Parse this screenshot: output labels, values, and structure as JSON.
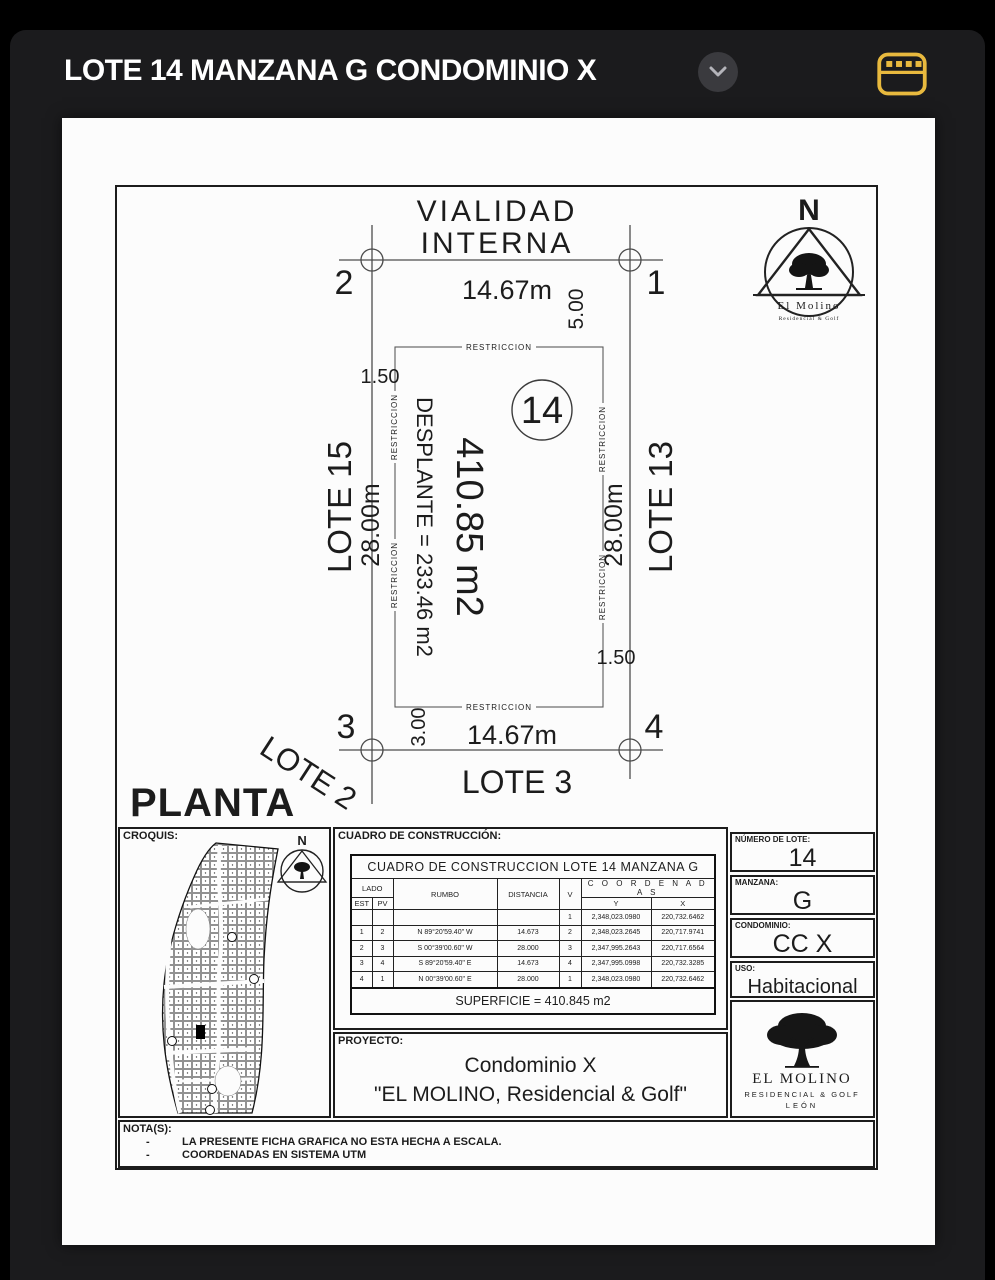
{
  "app": {
    "title": "LOTE 14 MANZANA G CONDOMINIO X",
    "accent_color": "#E8B93E"
  },
  "planta": {
    "street": {
      "line1": "VIALIDAD",
      "line2": "INTERNA"
    },
    "corner1": "1",
    "corner2": "2",
    "corner3": "3",
    "corner4": "4",
    "dim_front": "14.67m",
    "dim_rear": "14.67m",
    "dim_left": "28.00m",
    "dim_right": "28.00m",
    "setback_front": "5.00",
    "setback_rear": "3.00",
    "setback_left": "1.50",
    "setback_right": "1.50",
    "restriccion": "RESTRICCION",
    "lot_number": "14",
    "area": "410.85 m2",
    "desplante": "DESPLANTE = 233.46 m2",
    "lote_left": "LOTE 15",
    "lote_right": "LOTE 13",
    "lote_bottom_left": "LOTE 2",
    "lote_bottom": "LOTE 3",
    "view_label": "PLANTA",
    "north": {
      "letter": "N",
      "brand": "El Molino",
      "sub": "Residencial & Golf"
    }
  },
  "croquis": {
    "label": "CROQUIS:",
    "north_letter": "N"
  },
  "cuadro": {
    "label": "CUADRO DE CONSTRUCCIÓN:",
    "table_title": "CUADRO DE CONSTRUCCION LOTE 14 MANZANA G",
    "headers": {
      "lado": "LADO",
      "est": "EST",
      "pv": "PV",
      "rumbo": "RUMBO",
      "distancia": "DISTANCIA",
      "v": "V",
      "coordenadas": "C O O R D E N A D A S",
      "y": "Y",
      "x": "X"
    },
    "rows": [
      {
        "est": "",
        "pv": "",
        "rumbo": "",
        "dist": "",
        "v": "1",
        "y": "2,348,023.0980",
        "x": "220,732.6462"
      },
      {
        "est": "1",
        "pv": "2",
        "rumbo": "N 89°20'59.40\" W",
        "dist": "14.673",
        "v": "2",
        "y": "2,348,023.2645",
        "x": "220,717.9741"
      },
      {
        "est": "2",
        "pv": "3",
        "rumbo": "S 00°39'00.60\" W",
        "dist": "28.000",
        "v": "3",
        "y": "2,347,995.2643",
        "x": "220,717.6564"
      },
      {
        "est": "3",
        "pv": "4",
        "rumbo": "S 89°20'59.40\" E",
        "dist": "14.673",
        "v": "4",
        "y": "2,347,995.0998",
        "x": "220,732.3285"
      },
      {
        "est": "4",
        "pv": "1",
        "rumbo": "N 00°39'00.60\" E",
        "dist": "28.000",
        "v": "1",
        "y": "2,348,023.0980",
        "x": "220,732.6462"
      }
    ],
    "superficie": "SUPERFICIE = 410.845 m2"
  },
  "info": {
    "lote": {
      "label": "NÚMERO DE LOTE:",
      "value": "14"
    },
    "manzana": {
      "label": "MANZANA:",
      "value": "G"
    },
    "condominio": {
      "label": "CONDOMINIO:",
      "value": "CC X"
    },
    "uso": {
      "label": "USO:",
      "value": "Habitacional"
    }
  },
  "logo": {
    "name": "EL MOLINO",
    "sub": "RESIDENCIAL & GOLF",
    "city": "LEÓN"
  },
  "proyecto": {
    "label": "PROYECTO:",
    "line1": "Condominio X",
    "line2": "\"EL MOLINO, Residencial & Golf\""
  },
  "notas": {
    "label": "NOTA(S):",
    "items": [
      "LA PRESENTE FICHA GRAFICA NO ESTA HECHA A ESCALA.",
      "COORDENADAS EN SISTEMA UTM"
    ]
  }
}
